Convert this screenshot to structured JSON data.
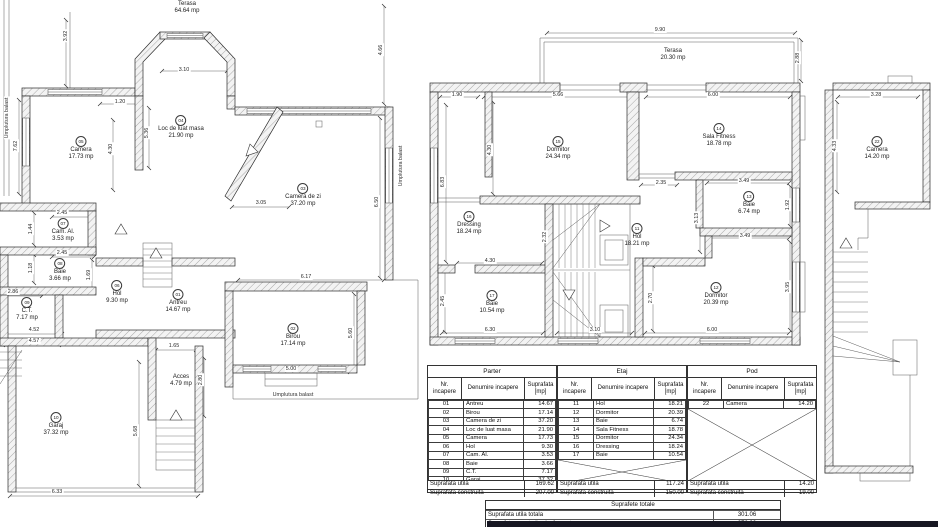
{
  "labels": {
    "umplutura_balast": "Umplutura balast"
  },
  "parter": {
    "terasa": {
      "name": "Terasa",
      "area": "64.64 mp"
    },
    "acces": {
      "name": "Acces",
      "area": "4.79 mp"
    },
    "rooms": [
      {
        "num": "01",
        "name": "Antreu",
        "area": "14.67 mp"
      },
      {
        "num": "02",
        "name": "Birou",
        "area": "17.14 mp"
      },
      {
        "num": "03",
        "name": "Camera de zi",
        "area": "37.20 mp"
      },
      {
        "num": "04",
        "name": "Loc de luat masa",
        "area": "21.90 mp"
      },
      {
        "num": "05",
        "name": "Camera",
        "area": "17.73 mp"
      },
      {
        "num": "06",
        "name": "Hol",
        "area": "9.30 mp"
      },
      {
        "num": "07",
        "name": "Cam. Al.",
        "area": "3.53 mp"
      },
      {
        "num": "08",
        "name": "Baie",
        "area": "3.66 mp"
      },
      {
        "num": "09",
        "name": "C.T.",
        "area": "7.17 mp"
      },
      {
        "num": "10",
        "name": "Garaj",
        "area": "37.32 mp"
      }
    ],
    "dims": [
      "3.92",
      "7.62",
      "3.10",
      "1.20",
      "4.30",
      "5.36",
      "3.05",
      "6.50",
      "4.66",
      "2.45",
      "1.44",
      "2.45",
      "1.18",
      "1.69",
      "2.86",
      "4.52",
      "4.57",
      "1.65",
      "2.80",
      "5.68",
      "6.33",
      "6.17",
      "5.60",
      "5.00"
    ]
  },
  "etaj": {
    "terasa": {
      "name": "Terasa",
      "area": "20.30 mp"
    },
    "rooms": [
      {
        "num": "11",
        "name": "Hol",
        "area": "18.21 mp"
      },
      {
        "num": "12",
        "name": "Dormitor",
        "area": "20.39 mp"
      },
      {
        "num": "13",
        "name": "Baie",
        "area": "6.74 mp"
      },
      {
        "num": "14",
        "name": "Sala Fitness",
        "area": "18.78 mp"
      },
      {
        "num": "15",
        "name": "Dormitor",
        "area": "24.34 mp"
      },
      {
        "num": "16",
        "name": "Dressing",
        "area": "18.24 mp"
      },
      {
        "num": "17",
        "name": "Baie",
        "area": "10.54 mp"
      }
    ],
    "dims": [
      "9.90",
      "2.88",
      "1.90",
      "5.66",
      "6.00",
      "4.30",
      "6.83",
      "2.35",
      "3.49",
      "3.13",
      "1.92",
      "3.49",
      "2.32",
      "4.30",
      "2.45",
      "6.30",
      "3.10",
      "2.70",
      "6.00",
      "3.95"
    ]
  },
  "pod": {
    "rooms": [
      {
        "num": "22",
        "name": "Camera",
        "area": "14.20 mp"
      }
    ],
    "dims": [
      "3.28",
      "4.33"
    ]
  },
  "area_table": {
    "col_headers": [
      "Nr. incapere",
      "Denumire incapere",
      "Suprafata [mp]"
    ],
    "groups": [
      {
        "title": "Parter",
        "rows": [
          [
            "01",
            "Antreu",
            "14.67"
          ],
          [
            "02",
            "Birou",
            "17.14"
          ],
          [
            "03",
            "Camera de zi",
            "37.20"
          ],
          [
            "04",
            "Loc de luat masa",
            "21.90"
          ],
          [
            "05",
            "Camera",
            "17.73"
          ],
          [
            "06",
            "Hol",
            "9.30"
          ],
          [
            "07",
            "Cam. Al.",
            "3.53"
          ],
          [
            "08",
            "Baie",
            "3.66"
          ],
          [
            "09",
            "C.T.",
            "7.17"
          ],
          [
            "10",
            "Garaj",
            "37.32"
          ]
        ],
        "utila_label": "Suprafata utila",
        "utila": "169.62",
        "construita_label": "Suprafata construita",
        "construita": "207.00"
      },
      {
        "title": "Etaj",
        "rows": [
          [
            "11",
            "Hol",
            "18.21"
          ],
          [
            "12",
            "Dormitor",
            "20.39"
          ],
          [
            "13",
            "Baie",
            "6.74"
          ],
          [
            "14",
            "Sala Fitness",
            "18.78"
          ],
          [
            "15",
            "Dormitor",
            "24.34"
          ],
          [
            "16",
            "Dressing",
            "18.24"
          ],
          [
            "17",
            "Baie",
            "10.54"
          ]
        ],
        "utila_label": "Suprafata utila",
        "utila": "117.24",
        "construita_label": "Suprafata construita",
        "construita": "150.00"
      },
      {
        "title": "Pod",
        "rows": [
          [
            "22",
            "Camera",
            "14.20"
          ]
        ],
        "utila_label": "Suprafata utila",
        "utila": "14.20",
        "construita_label": "Suprafata construita",
        "construita": "19.00"
      }
    ]
  },
  "totals_table": {
    "title": "Suprafete totale",
    "rows": [
      [
        "Suprafata utila totala",
        "301.06"
      ],
      [
        "Suprafata construita desfasurata",
        "376.00"
      ]
    ]
  }
}
